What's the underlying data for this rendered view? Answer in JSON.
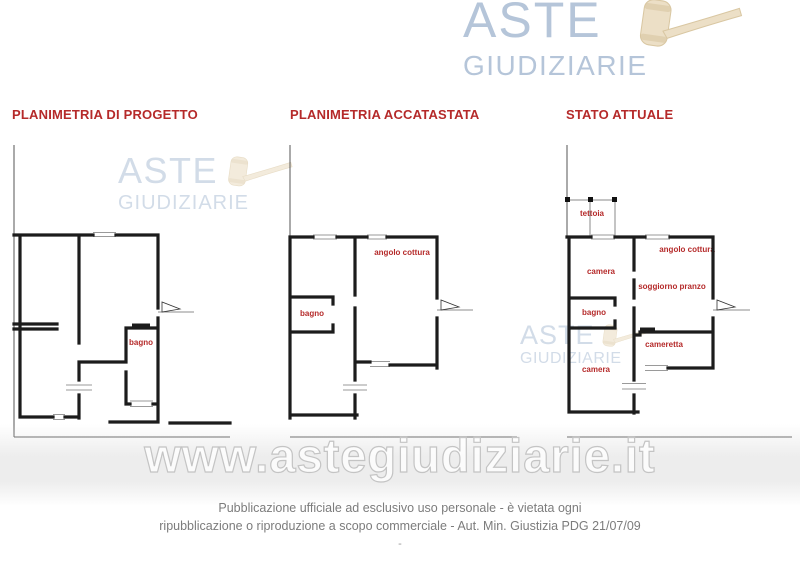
{
  "logo": {
    "word1": "ASTE",
    "word2": "GIUDIZIARIE"
  },
  "plans": [
    {
      "title": "PLANIMETRIA DI PROGETTO",
      "rooms": [
        "bagno"
      ]
    },
    {
      "title": "PLANIMETRIA ACCATASTATA",
      "rooms": [
        "angolo cottura",
        "bagno"
      ]
    },
    {
      "title": "STATO ATTUALE",
      "rooms": [
        "tettoia",
        "camera",
        "angolo cottura",
        "soggiorno pranzo",
        "bagno",
        "cameretta",
        "camera"
      ]
    }
  ],
  "watermark": {
    "site": "www.astegiudiziarie.it",
    "logo_word1": "ASTE",
    "logo_word2": "GIUDIZIARIE"
  },
  "footer": {
    "line1": "Pubblicazione ufficiale ad esclusivo uso personale - è vietata ogni",
    "line2": "ripubblicazione o riproduzione a scopo commerciale - Aut. Min. Giustizia PDG 21/07/09",
    "line3": "-"
  },
  "colors": {
    "accent_red": "#b52a2a",
    "logo_blue": "#b5c5d9",
    "gavel_fill": "#ecdfc6",
    "gavel_stroke": "#d9c7a2",
    "wall_black": "#1c1c1c",
    "watermark_gray": "#c4c4c4",
    "footer_gray": "#7c7c7c"
  }
}
